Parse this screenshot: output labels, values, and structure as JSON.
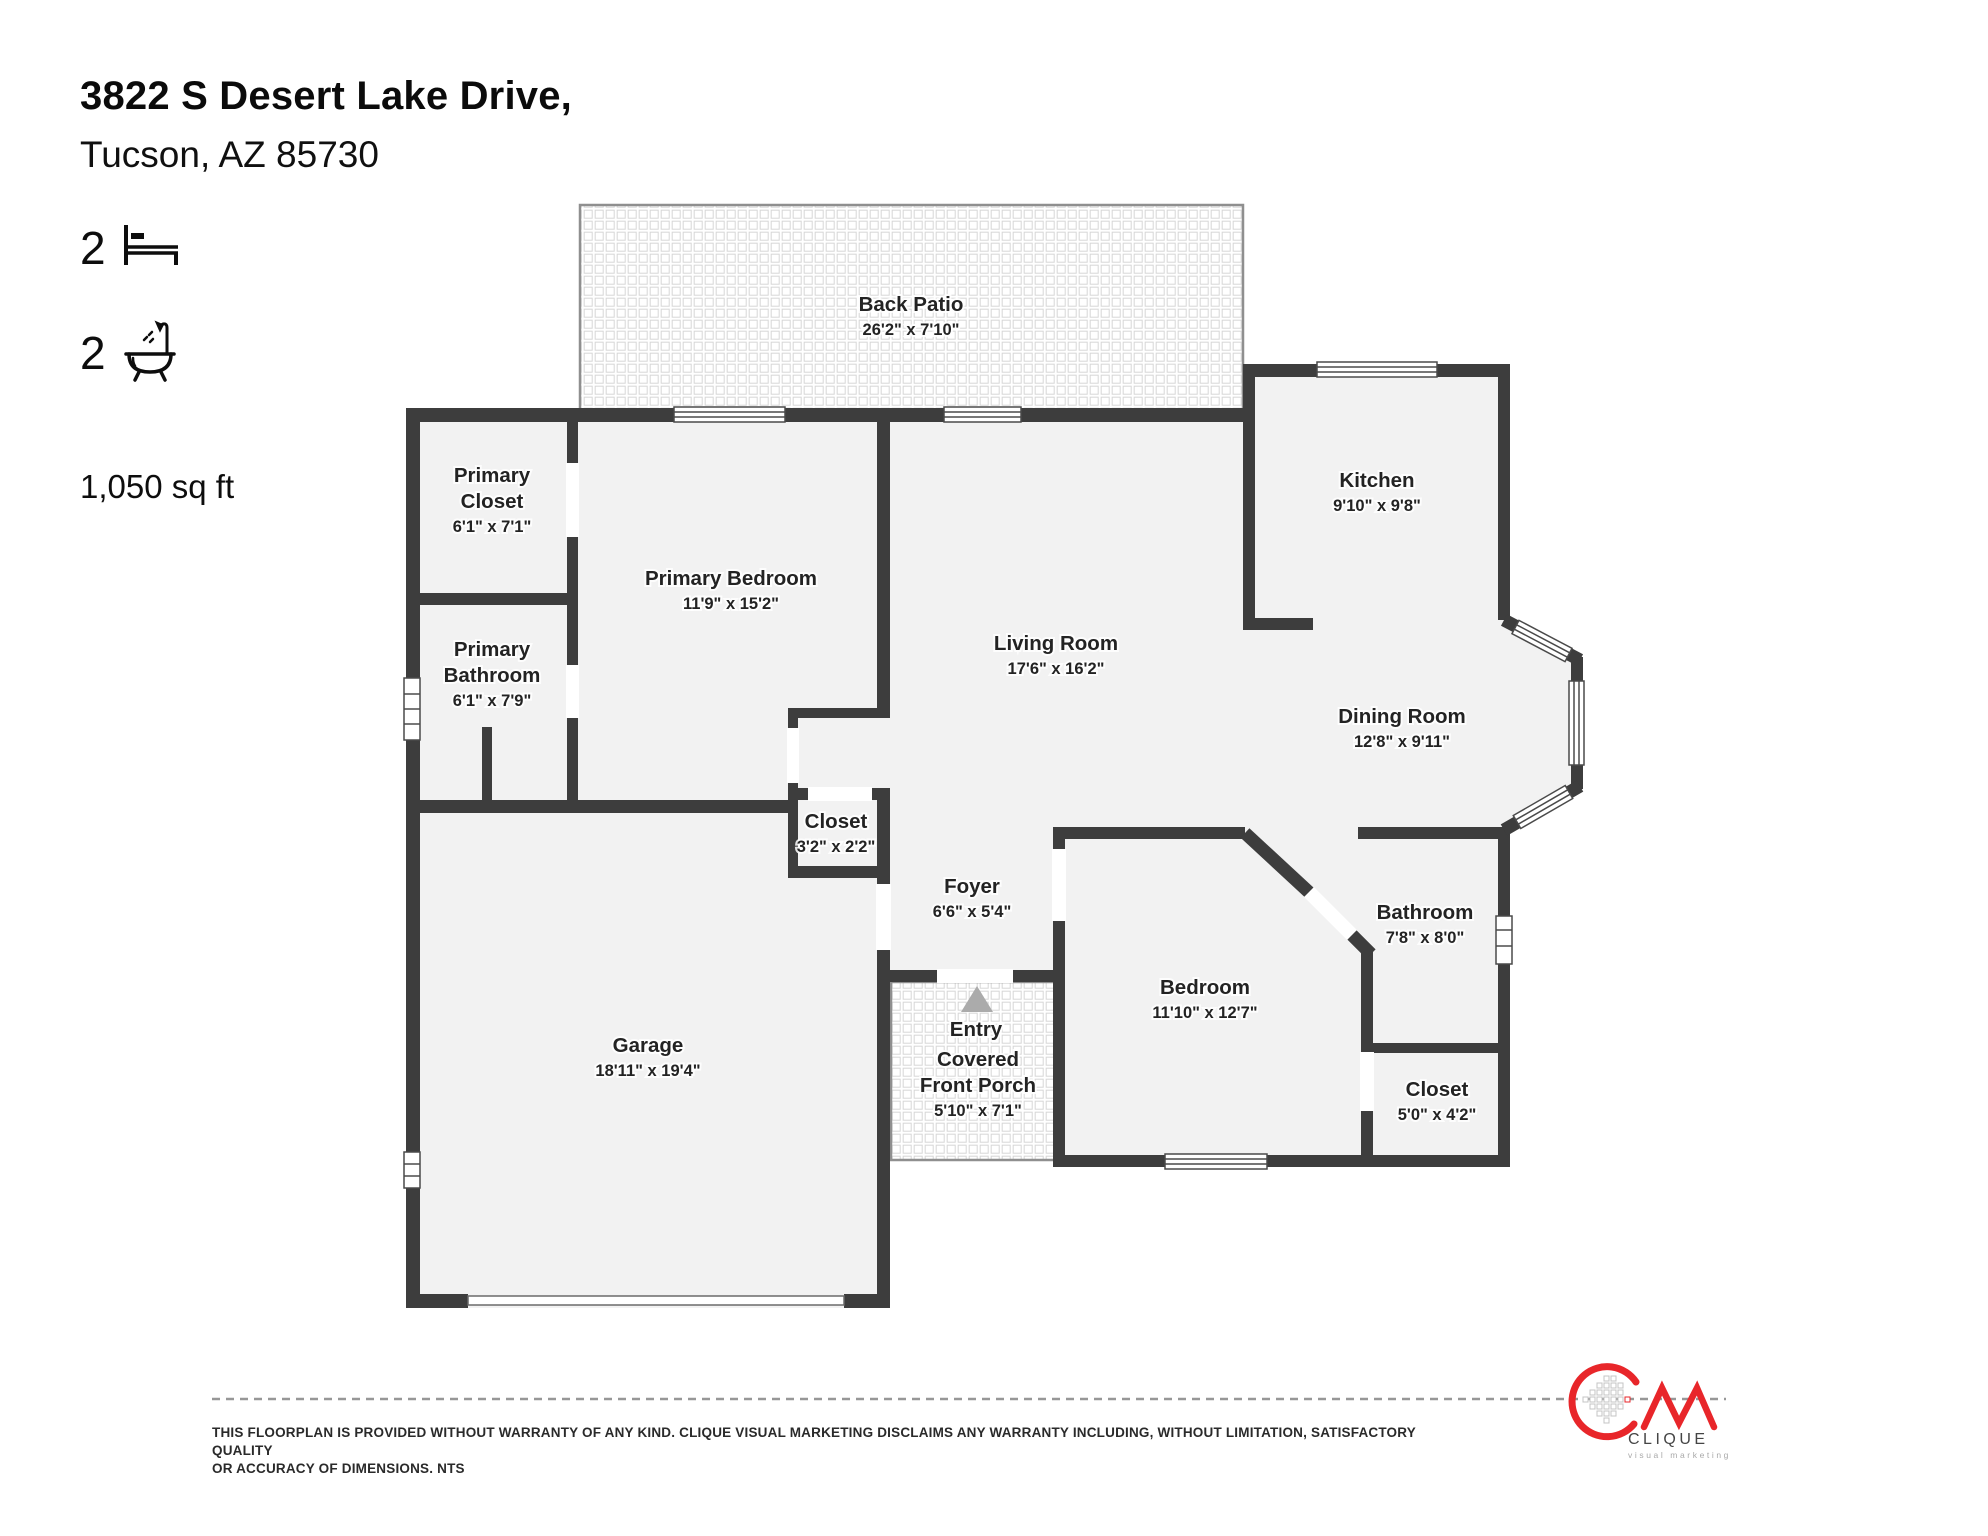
{
  "header": {
    "address_line1": "3822 S Desert Lake Drive,",
    "address_line2": "Tucson, AZ 85730"
  },
  "stats": {
    "bedrooms": "2",
    "bathrooms": "2",
    "area": "1,050 sq ft"
  },
  "floorplan": {
    "rooms": [
      {
        "id": "back-patio",
        "lines": [
          "Back Patio"
        ],
        "dims": "26'2\" x 7'10\"",
        "x": 911,
        "y": 311
      },
      {
        "id": "primary-closet",
        "lines": [
          "Primary",
          "Closet"
        ],
        "dims": "6'1\" x 7'1\"",
        "x": 492,
        "y": 482
      },
      {
        "id": "kitchen",
        "lines": [
          "Kitchen"
        ],
        "dims": "9'10\" x 9'8\"",
        "x": 1377,
        "y": 487
      },
      {
        "id": "primary-bedroom",
        "lines": [
          "Primary Bedroom"
        ],
        "dims": "11'9\" x 15'2\"",
        "x": 731,
        "y": 585
      },
      {
        "id": "living-room",
        "lines": [
          "Living Room"
        ],
        "dims": "17'6\" x 16'2\"",
        "x": 1056,
        "y": 650
      },
      {
        "id": "primary-bathroom",
        "lines": [
          "Primary",
          "Bathroom"
        ],
        "dims": "6'1\" x 7'9\"",
        "x": 492,
        "y": 656
      },
      {
        "id": "dining-room",
        "lines": [
          "Dining Room"
        ],
        "dims": "12'8\" x 9'11\"",
        "x": 1402,
        "y": 723
      },
      {
        "id": "closet-hall",
        "lines": [
          "Closet"
        ],
        "dims": "3'2\" x 2'2\"",
        "x": 836,
        "y": 828
      },
      {
        "id": "foyer",
        "lines": [
          "Foyer"
        ],
        "dims": "6'6\" x 5'4\"",
        "x": 972,
        "y": 893
      },
      {
        "id": "bathroom",
        "lines": [
          "Bathroom"
        ],
        "dims": "7'8\" x 8'0\"",
        "x": 1425,
        "y": 919
      },
      {
        "id": "bedroom",
        "lines": [
          "Bedroom"
        ],
        "dims": "11'10\" x 12'7\"",
        "x": 1205,
        "y": 994
      },
      {
        "id": "entry",
        "lines": [
          "Entry"
        ],
        "dims": "",
        "x": 976,
        "y": 1036
      },
      {
        "id": "covered-front-porch",
        "lines": [
          "Covered",
          "Front Porch"
        ],
        "dims": "5'10\" x 7'1\"",
        "x": 978,
        "y": 1066
      },
      {
        "id": "garage",
        "lines": [
          "Garage"
        ],
        "dims": "18'11\" x 19'4\"",
        "x": 648,
        "y": 1052
      },
      {
        "id": "closet-bedroom",
        "lines": [
          "Closet"
        ],
        "dims": "5'0\" x 4'2\"",
        "x": 1437,
        "y": 1096
      }
    ]
  },
  "disclaimer": {
    "line1": "THIS FLOORPLAN IS PROVIDED WITHOUT WARRANTY OF ANY KIND. CLIQUE VISUAL MARKETING DISCLAIMS ANY WARRANTY INCLUDING, WITHOUT LIMITATION, SATISFACTORY QUALITY",
    "line2": "OR ACCURACY OF DIMENSIONS. NTS"
  },
  "logo": {
    "brand": "CLIQUE",
    "tagline": "visual marketing"
  },
  "colors": {
    "wall": "#3d3d3d",
    "floor": "#f2f2f2",
    "accent_red": "#e8262a",
    "label": "#232323"
  }
}
